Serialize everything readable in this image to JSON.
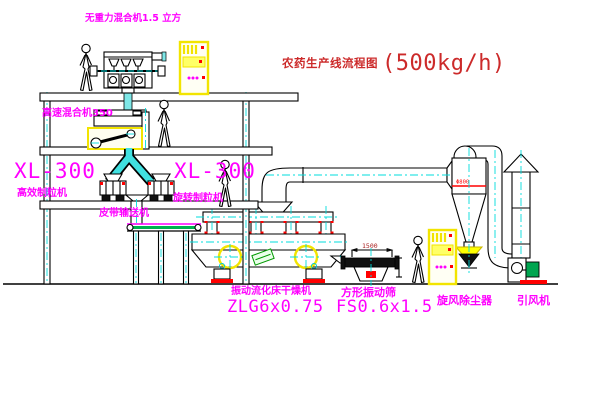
{
  "title": {
    "name_zh": "农药生产线流程图",
    "capacity": "(500kg/h)"
  },
  "labels": {
    "gravity_mixer": "无重力混合机1.5 立方",
    "high_speed_mixer": "高速混合机350",
    "left_granulator_model": "XL-300",
    "left_granulator_name": "高效制粒机",
    "right_granulator_model": "XL-300",
    "right_granulator_name": "旋转制粒机",
    "belt_conveyor": "皮带输送机",
    "dryer_name": "振动流化床干燥机",
    "dryer_model": "ZLG6x0.75",
    "sieve_name": "方形振动筛",
    "sieve_model": "FS0.6x1.5",
    "cyclone_name": "旋风除尘器",
    "fan_name": "引风机",
    "sieve_dim": "1500",
    "cyclone_dim": "Φ800"
  },
  "colors": {
    "label_magenta": "#ff00ff",
    "title_red": "#cc2a2a",
    "pipe_cyan": "#00dcdc",
    "equipment_yellow": "#f2e400",
    "alert_red": "#ff0000",
    "motor_green": "#00a550",
    "line_black": "#000000"
  }
}
